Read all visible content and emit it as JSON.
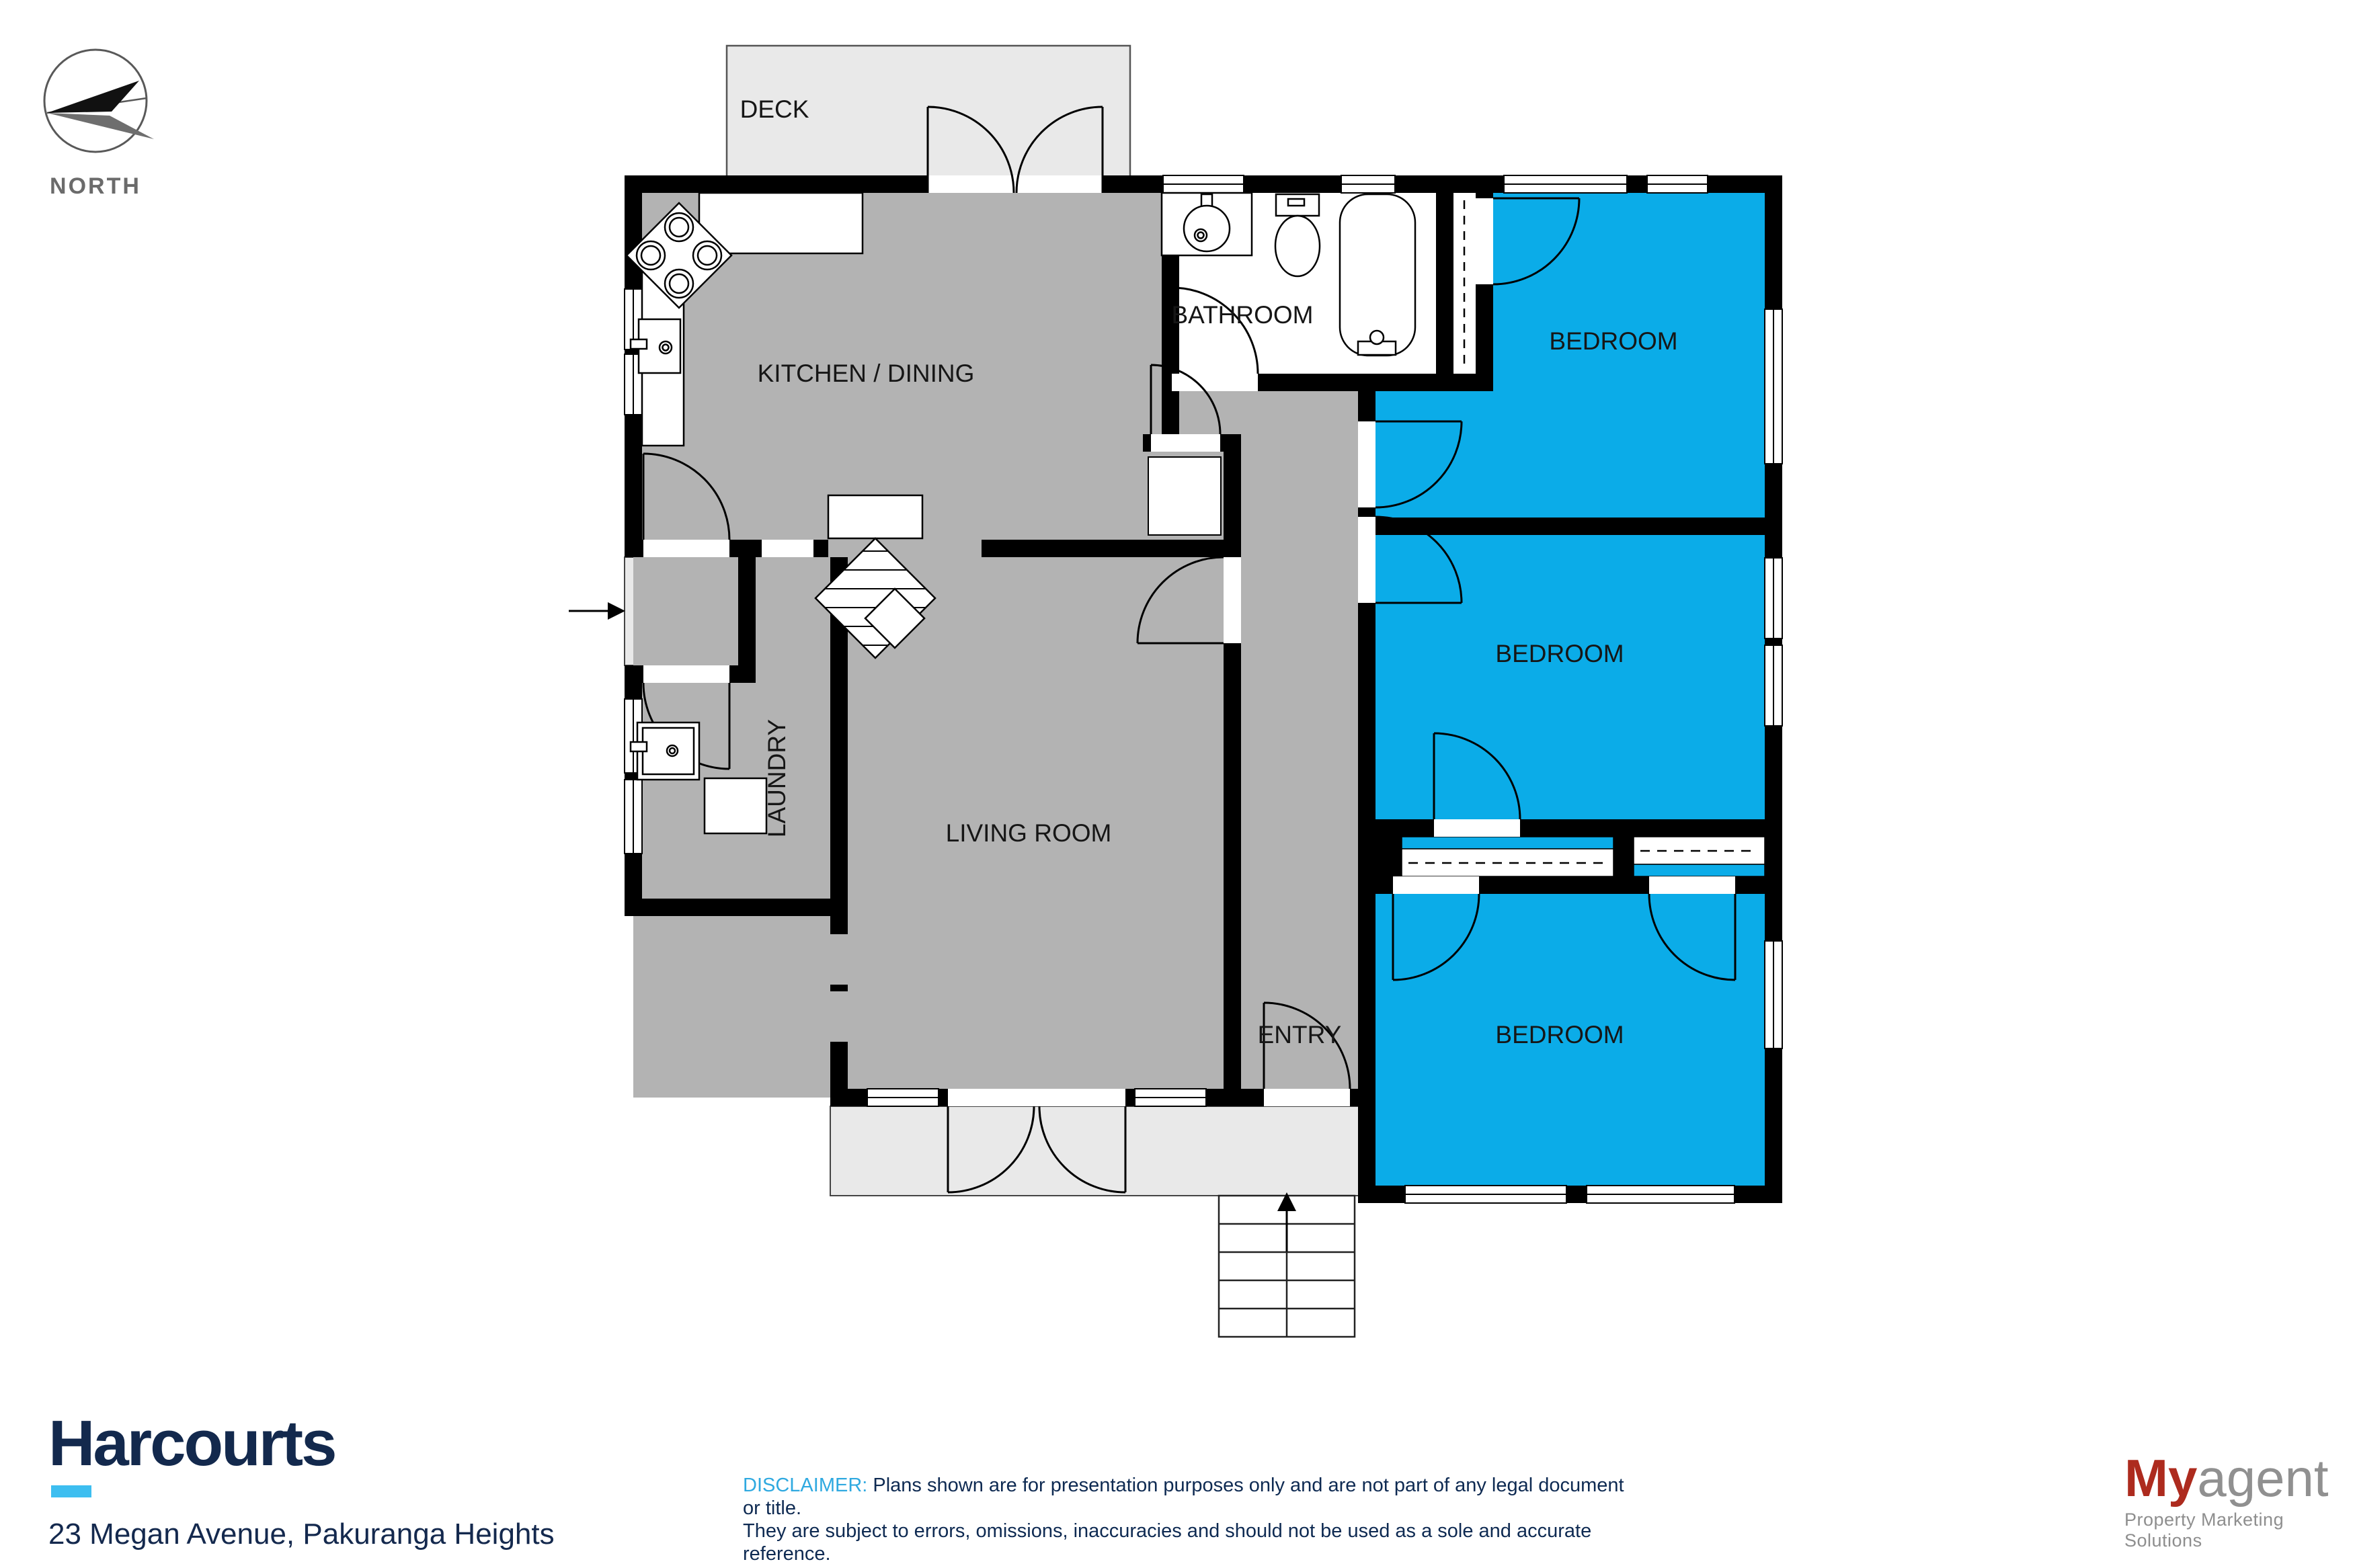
{
  "compass": {
    "label": "NORTH"
  },
  "plan": {
    "colors": {
      "bedroom_blue": "#0BACE8",
      "floor_gray": "#B3B3B3",
      "porch_gray": "#E9E9E9",
      "wall_black": "#000000"
    },
    "rooms": {
      "deck": "DECK",
      "kitchen": "KITCHEN / DINING",
      "bathroom": "BATHROOM",
      "bedroom1": "BEDROOM",
      "bedroom2": "BEDROOM",
      "bedroom3": "BEDROOM",
      "living": "LIVING ROOM",
      "laundry": "LAUNDRY",
      "entry": "ENTRY"
    }
  },
  "footer": {
    "brand": "Harcourts",
    "address": "23 Megan Avenue, Pakuranga Heights",
    "disclaimer_label": "DISCLAIMER:",
    "disclaimer_lines": [
      "Plans shown are for presentation purposes only and are not part of any legal document or title.",
      "They are subject to errors, omissions, inaccuracies and should not be used as a sole and accurate reference.",
      "Interested parties should make their own inquiries using independent sources."
    ],
    "agency": {
      "name_accent": "My",
      "name_rest": "agent",
      "tagline": "Property Marketing Solutions"
    }
  }
}
